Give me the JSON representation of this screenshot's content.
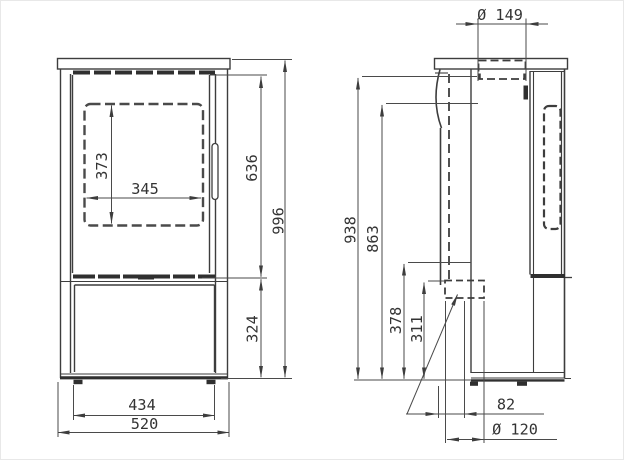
{
  "drawing_title": "Stove dimensional drawing — front and side views",
  "front_view": {
    "dims": {
      "glass_height": "373",
      "glass_width": "345",
      "upper_section_height": "636",
      "total_height": "996",
      "base_section_height": "324",
      "body_width": "434",
      "total_width": "520"
    }
  },
  "side_view": {
    "dims": {
      "flue_collar_diameter": "Ø 149",
      "rear_flue_top_height": "938",
      "rear_flue_center_height": "863",
      "air_inlet_upper_height": "378",
      "air_inlet_height": "311",
      "air_inlet_rear_offset": "82",
      "air_inlet_diameter": "Ø 120"
    }
  },
  "colors": {
    "line": "#3d3d3d",
    "dark_strip": "#2f2f2f",
    "dim_line": "#4a4a4a",
    "text": "#333333",
    "background": "#ffffff"
  }
}
